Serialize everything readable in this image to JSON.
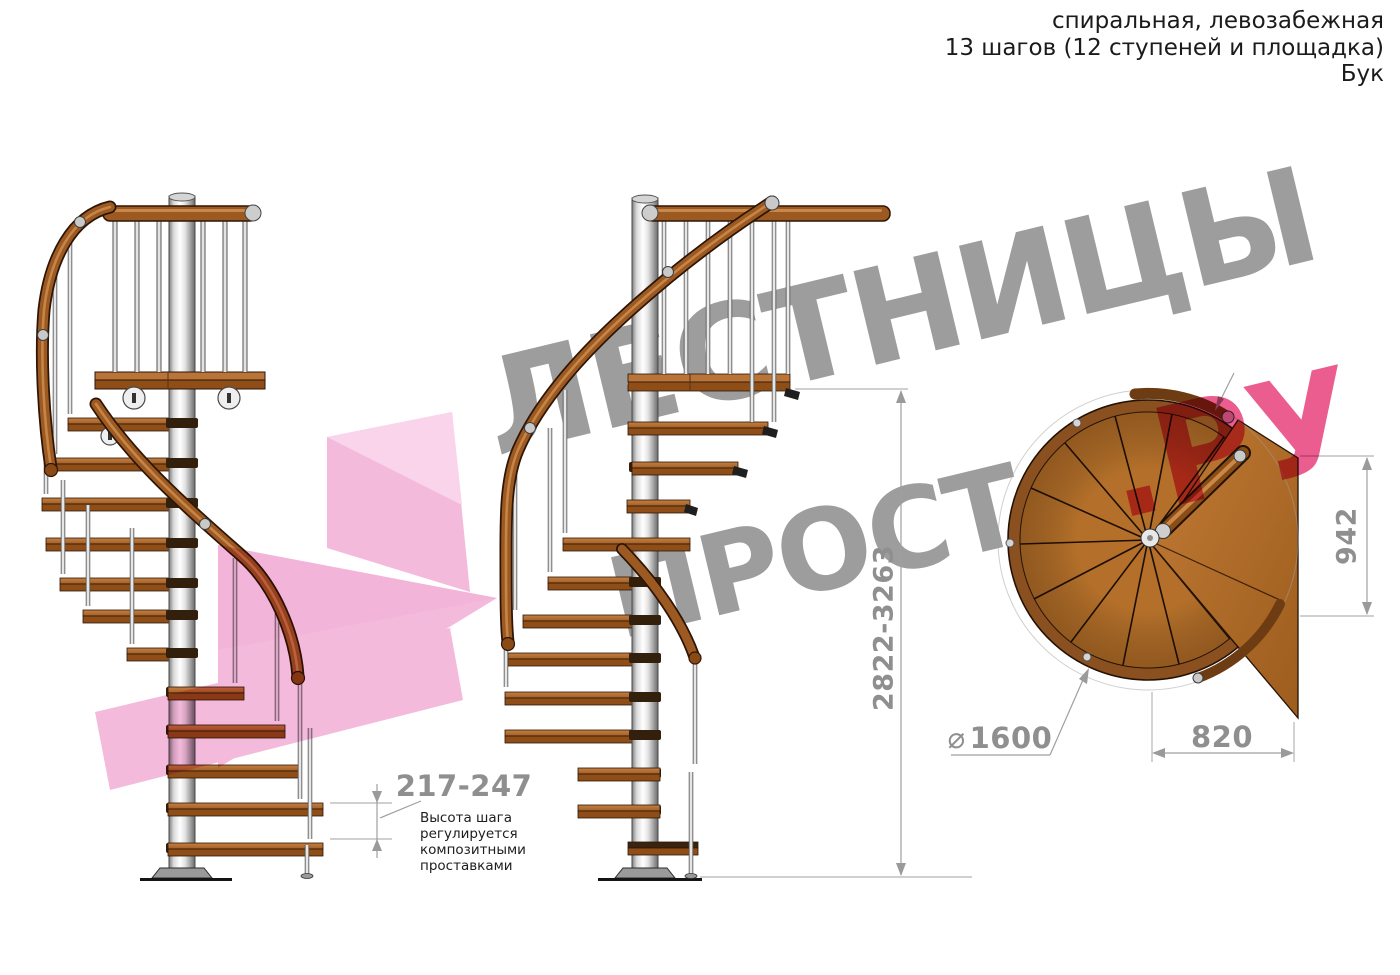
{
  "header": {
    "line1": "спиральная, левозабежная",
    "line2": "13 шагов (12 ступеней и площадка)",
    "line3": "Бук"
  },
  "watermark": {
    "line1": "ЛЕСТНИЦЫ",
    "line2_gray": "ПРОСТО",
    "line2_pink": ".РУ",
    "text_color": "#9d9d9d",
    "accent_pink": "#eb4f85",
    "arrow_pink": "#f2abd5",
    "arrow_pink_light": "#f8cbe6",
    "arrow_pink_deep": "#ec9bca"
  },
  "dimensions": {
    "total_height": "2822-3263",
    "step_height": "217-247",
    "step_note": "Высота шага\nрегулируется\nкомпозитными\nпроставками",
    "landing_height": "942",
    "landing_width": "820",
    "diameter_symbol": "⌀",
    "diameter_value": "1600"
  },
  "colors": {
    "wood_top": "#b9743a",
    "wood_front": "#8f4e18",
    "rail_wood": "#9c5a22",
    "rim_wood": "#8a5020",
    "deck_wood": "#b4702a",
    "pole_metal": "#c9c9c9",
    "dim_line": "#9f9f9f",
    "dim_text": "#8f8f8f",
    "header_text": "#1b1b1b"
  }
}
